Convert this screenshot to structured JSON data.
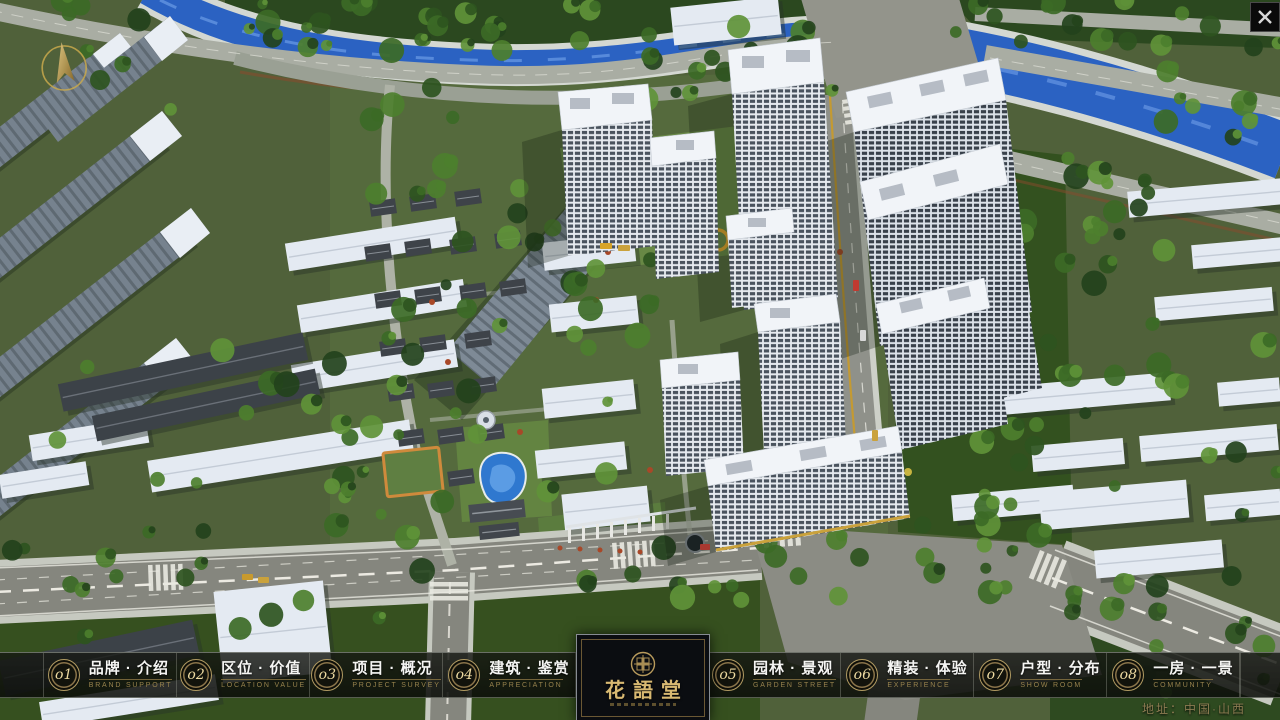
{
  "window": {
    "close_icon": "X"
  },
  "nav": {
    "items": [
      {
        "num": "o1",
        "cn": "品牌 · 介绍",
        "en": "BRAND SUPPORT"
      },
      {
        "num": "o2",
        "cn": "区位 · 价值",
        "en": "LOCATION VALUE"
      },
      {
        "num": "o3",
        "cn": "项目 · 概况",
        "en": "PROJECT SURVEY"
      },
      {
        "num": "o4",
        "cn": "建筑 · 鉴赏",
        "en": "APPRECIATION"
      },
      {
        "num": "o5",
        "cn": "园林 · 景观",
        "en": "GARDEN STREET"
      },
      {
        "num": "o6",
        "cn": "精装 · 体验",
        "en": "EXPERIENCE"
      },
      {
        "num": "o7",
        "cn": "户型 · 分布",
        "en": "SHOW ROOM"
      },
      {
        "num": "o8",
        "cn": "一房 · 一景",
        "en": "COMMUNITY"
      }
    ]
  },
  "logo": {
    "title": "花語堂"
  },
  "footer": {
    "address": "地址：中国·山西"
  },
  "colors": {
    "gold_accent": "#c9a84c",
    "badge_ring": "#8a744a",
    "nav_text": "#f5f5f3",
    "nav_subtext": "#97824d",
    "logo_gold": "#d8b972",
    "water_blue": "#2b62c2"
  }
}
